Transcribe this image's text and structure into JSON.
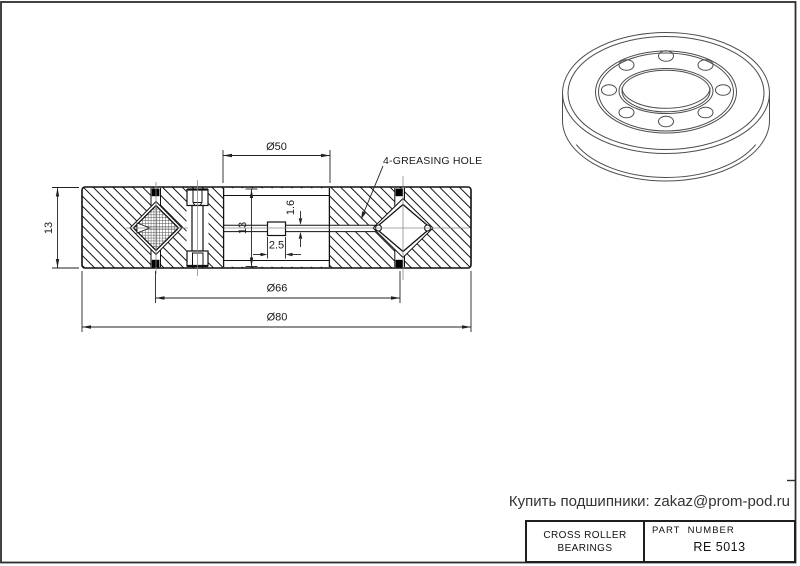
{
  "colors": {
    "line": "#161616",
    "dimension": "#222222",
    "centerline": "#8a8a8a",
    "view3d_line": "#4d4d4d",
    "footer_text": "#333333"
  },
  "section_view": {
    "dims": {
      "height_left": "13",
      "bore": "Ø50",
      "inner_height": "13",
      "grease_hole_height": "1.6",
      "grease_hole_width": "2.5",
      "roller_pitch": "Ø66",
      "outer": "Ø80"
    },
    "annotation": "4-GREASING HOLE"
  },
  "footer": {
    "contact": "Купить подшипники: zakaz@prom-pod.ru"
  },
  "title_block": {
    "left_line1": "CROSS ROLLER",
    "left_line2": "BEARINGS",
    "part_number_label": "PART  NUMBER",
    "part_number_value": "RE 5013"
  }
}
